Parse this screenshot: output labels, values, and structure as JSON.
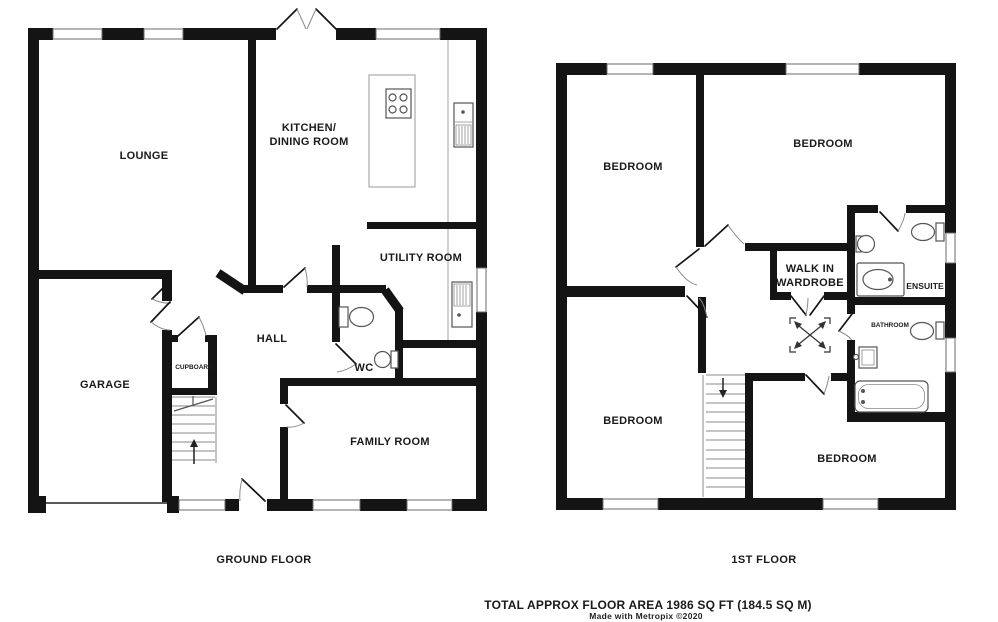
{
  "floors": [
    {
      "name": "GROUND FLOOR",
      "rooms": {
        "lounge": "LOUNGE",
        "kitchen_line1": "KITCHEN/",
        "kitchen_line2": "DINING ROOM",
        "utility": "UTILITY ROOM",
        "hall": "HALL",
        "cupboard": "CUPBOARD",
        "wc": "WC",
        "garage": "GARAGE",
        "family": "FAMILY ROOM"
      }
    },
    {
      "name": "1ST FLOOR",
      "rooms": {
        "bedroom_top_left": "BEDROOM",
        "bedroom_top_right": "BEDROOM",
        "bedroom_bottom_left": "BEDROOM",
        "bedroom_bottom_right": "BEDROOM",
        "wardrobe_line1": "WALK IN",
        "wardrobe_line2": "WARDROBE",
        "ensuite": "ENSUITE",
        "bathroom": "BATHROOM"
      }
    }
  ],
  "footer": {
    "total_area": "TOTAL APPROX FLOOR AREA 1986 SQ FT (184.5 SQ M)",
    "credit": "Made with Metropix ©2020"
  },
  "colors": {
    "wall": "#141414",
    "background": "#ffffff"
  }
}
